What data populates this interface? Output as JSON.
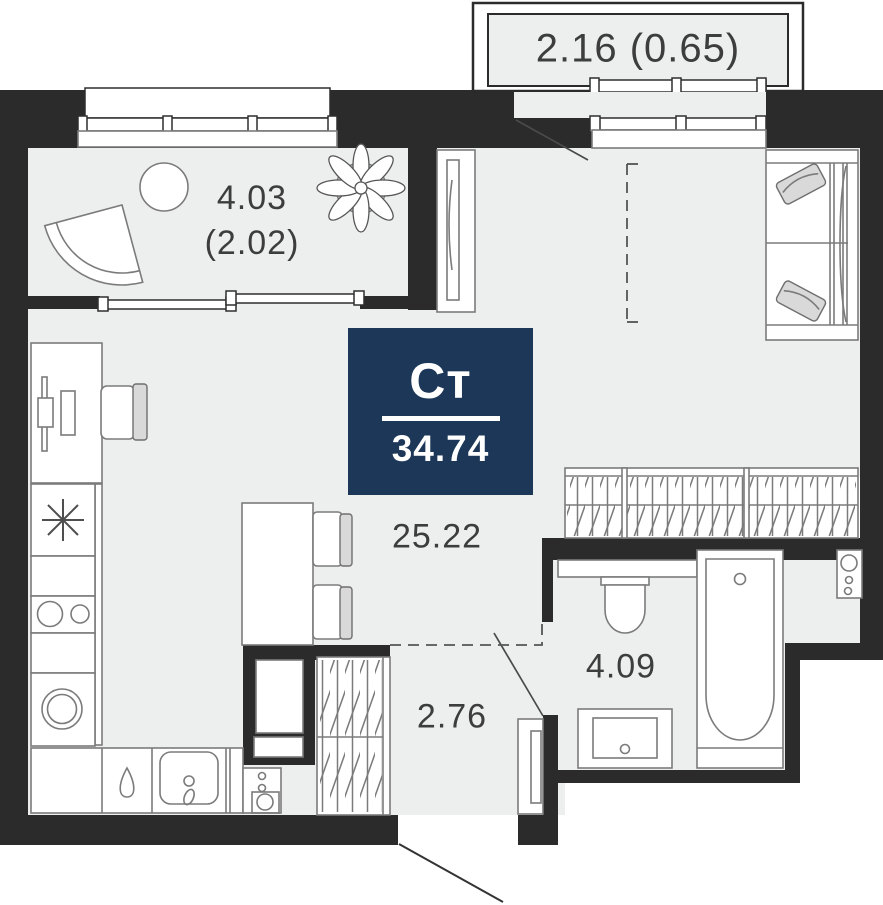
{
  "plan": {
    "badge": {
      "type": "Ст",
      "area": "34.74",
      "bg": "#1c3758"
    },
    "labels": {
      "balcony_top": "2.16 (0.65)",
      "balcony_left_line1": "4.03",
      "balcony_left_line2": "(2.02)",
      "living": "25.22",
      "hall": "2.76",
      "bathroom": "4.09"
    },
    "colors": {
      "wall": "#2b2b2b",
      "floor": "#edefee",
      "badge_bg": "#1c3758",
      "furniture_outline": "#7b7b7b",
      "text": "#3d3d3d"
    },
    "furniture_symbols": [
      "sofa-with-pillows",
      "tall-cabinet",
      "wardrobe-hanging-rail",
      "entrance-wardrobe-hanging-rail",
      "dining-table-with-two-chairs",
      "desk-with-chair",
      "fridge-snowflake",
      "stove-burners",
      "washing-machine",
      "kitchen-counter",
      "kitchen-sink",
      "water-drop-hob",
      "toilet",
      "bathroom-sink",
      "bathtub",
      "meter-panel",
      "duct-shaft",
      "electrical-panel",
      "balcony-armchair",
      "balcony-round-table",
      "plant",
      "balcony-glazing",
      "entrance-door-swing",
      "balcony-door-swing",
      "bathroom-door"
    ]
  }
}
